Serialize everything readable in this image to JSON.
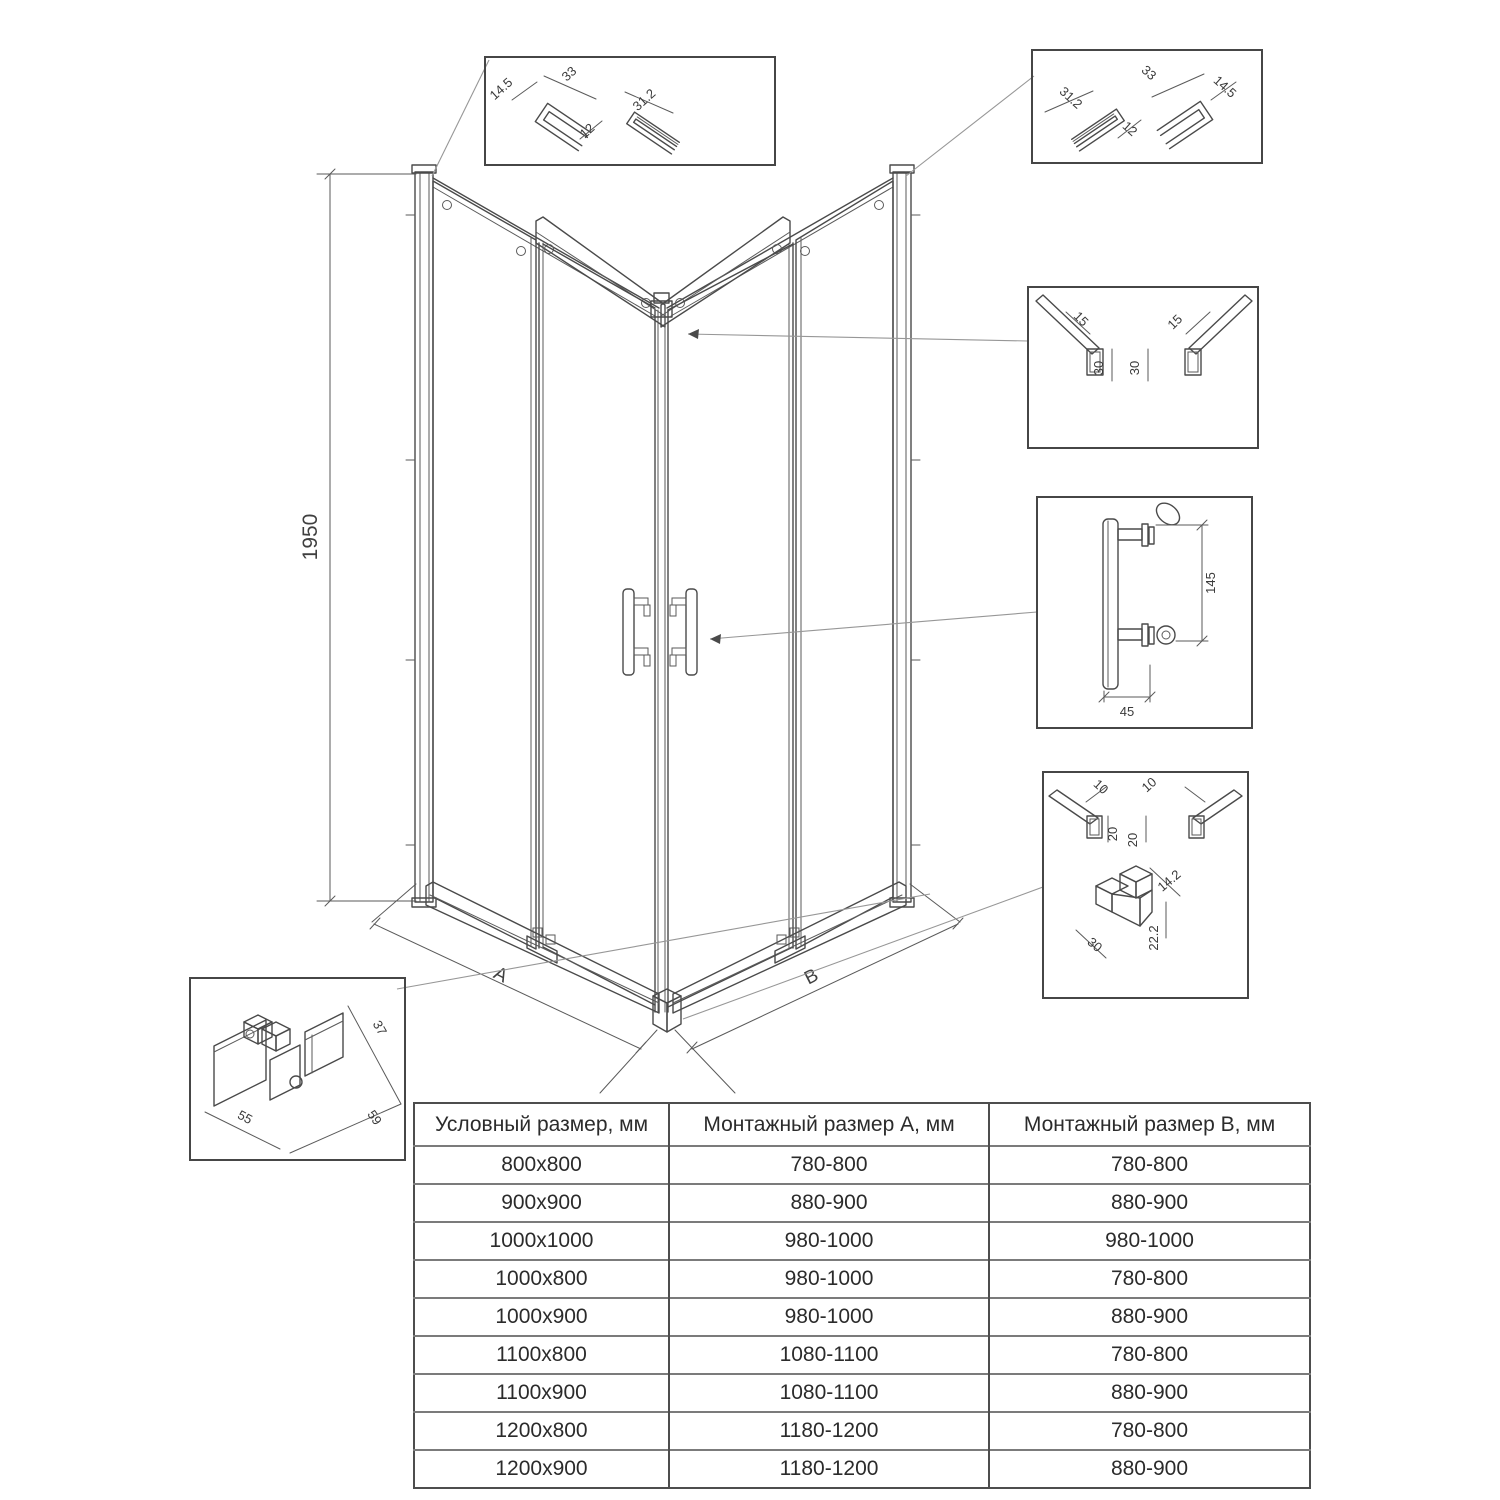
{
  "dimensions": {
    "height": "1950",
    "width_a": "A",
    "width_b": "B"
  },
  "details": {
    "wall_profile_left": [
      "14.5",
      "33",
      "12",
      "31.2"
    ],
    "wall_profile_right": [
      "31.2",
      "12",
      "33",
      "14.5"
    ],
    "top_rail": [
      "15",
      "15",
      "30",
      "30"
    ],
    "handle": [
      "145",
      "45"
    ],
    "bottom_rail": [
      "10",
      "10",
      "20",
      "20",
      "14.2",
      "22.2",
      "30"
    ],
    "roller": [
      "37",
      "55",
      "59"
    ]
  },
  "table": {
    "headers": [
      "Условный размер, мм",
      "Монтажный размер А, мм",
      "Монтажный размер В, мм"
    ],
    "rows": [
      {
        "size": "800x800",
        "a": "780-800",
        "b": "780-800"
      },
      {
        "size": "900x900",
        "a": "880-900",
        "b": "880-900"
      },
      {
        "size": "1000x1000",
        "a": "980-1000",
        "b": "980-1000"
      },
      {
        "size": "1000x800",
        "a": "980-1000",
        "b": "780-800"
      },
      {
        "size": "1000x900",
        "a": "980-1000",
        "b": "880-900"
      },
      {
        "size": "1100x800",
        "a": "1080-1100",
        "b": "780-800"
      },
      {
        "size": "1100x900",
        "a": "1080-1100",
        "b": "880-900"
      },
      {
        "size": "1200x800",
        "a": "1180-1200",
        "b": "780-800"
      },
      {
        "size": "1200x900",
        "a": "1180-1200",
        "b": "880-900"
      }
    ]
  },
  "colors": {
    "line": "#4a4a4a",
    "leader": "#979797",
    "text": "#3a3a3a",
    "table_border": "#4d4d4d",
    "background": "#ffffff"
  }
}
